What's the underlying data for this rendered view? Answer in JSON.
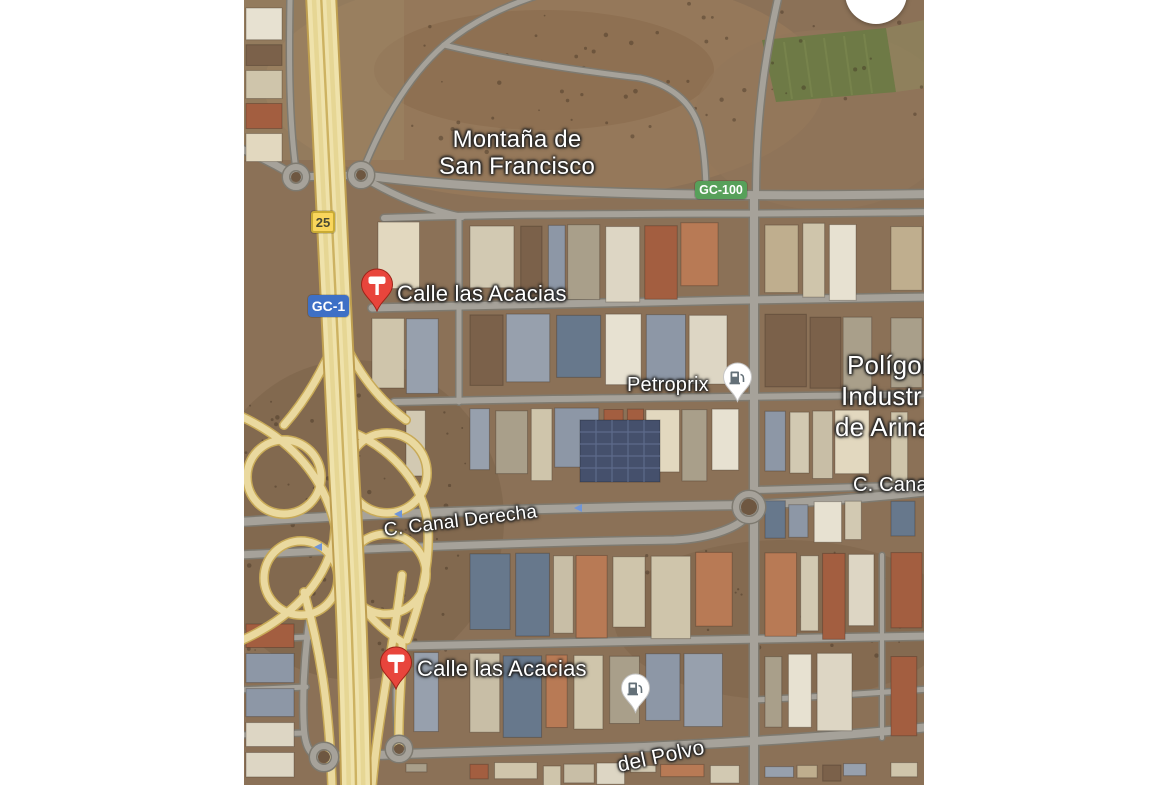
{
  "window": {
    "width": 1170,
    "height": 785,
    "background": "#ffffff"
  },
  "map": {
    "kind": "google-maps-satellite-view",
    "avatar_button": {
      "shape": "circle",
      "color": "#ffffff",
      "partially_visible": true
    },
    "labels": {
      "area": [
        {
          "name": "montana-de-san-francisco",
          "line1": "Montaña de",
          "line2": "San Francisco"
        },
        {
          "name": "poligono-industrial-de-arinaga",
          "line1": "Polígon",
          "line2": "Industr",
          "line3": "de Arina",
          "truncated": true
        }
      ],
      "streets": [
        {
          "name": "c-canal-derecha",
          "text": "C. Canal Derecha",
          "rotation_deg": -7
        },
        {
          "name": "c-canal",
          "text": "C. Cana",
          "truncated": true
        },
        {
          "name": "del-polvo",
          "text": "del Polvo",
          "rotation_deg": -12,
          "truncated": true
        }
      ]
    },
    "route_badges": [
      {
        "name": "exit-25",
        "text": "25",
        "bg": "#f9d65c",
        "fg": "#4a4a33"
      },
      {
        "name": "gc-1",
        "text": "GC-1",
        "bg": "#3e70c6",
        "fg": "#ffffff"
      },
      {
        "name": "gc-100",
        "text": "GC-100",
        "bg": "#57a05a",
        "fg": "#ffffff"
      }
    ],
    "markers": [
      {
        "name": "calle-las-acacias-north",
        "label": "Calle las Acacias",
        "pin": "red-signpost-pin",
        "pin_color": "#e8453c"
      },
      {
        "name": "calle-las-acacias-south",
        "label": "Calle las Acacias",
        "pin": "red-signpost-pin",
        "pin_color": "#e8453c"
      },
      {
        "name": "petroprix-gas-station",
        "label": "Petroprix",
        "pin": "white-gas-pin",
        "pin_color": "#ffffff"
      },
      {
        "name": "gas-station-unlabeled",
        "label": "",
        "pin": "white-gas-pin",
        "pin_color": "#ffffff"
      }
    ],
    "terrain_colors": {
      "ground": "#8b7157",
      "road": "#a6a29a",
      "highway": "#efe2ab",
      "field_green": "#6e7a46"
    }
  }
}
